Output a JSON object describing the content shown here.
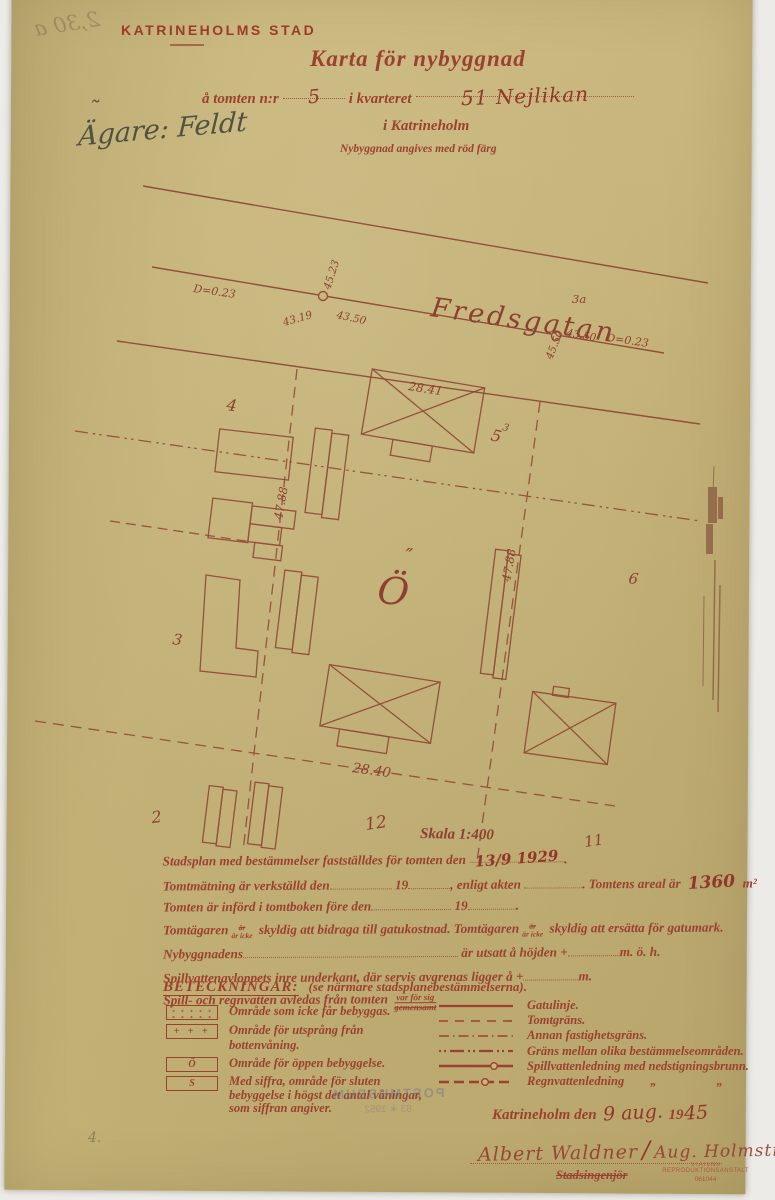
{
  "header": {
    "agency": "KATRINEHOLMS STAD",
    "title": "Karta för nybyggnad",
    "line_pre": "å tomten n:r",
    "plot_no": "5",
    "line_mid": "i kvarteret",
    "block_entry": "51 Nejlikan",
    "city_line": "i Katrineholm",
    "note": "Nybyggnad angives med röd färg",
    "owner_label_and_name": "Ägare: Feldt",
    "owner_tilde": "˜"
  },
  "map": {
    "street_name": "Fredsgatan",
    "d_left": "D=0.23",
    "d_right": "D=0.23",
    "manhole1_left": "43.19",
    "manhole1_up": "45.23",
    "manhole1_right": "43.50",
    "manhole2_label": "3a",
    "manhole2_right": "43.50",
    "manhole2_up": "45.50",
    "frontage_left": "47.88",
    "frontage_right": "47.88",
    "building_top_len": "28.41",
    "building_mid_len": "28.40",
    "plot2": "2",
    "plot3": "3",
    "plot4": "4",
    "plot5": "5",
    "plot5_sup": "3",
    "plot6": "6",
    "plot11": "11",
    "plot12": "12",
    "scale_label": "Skala 1:400",
    "open_symbol": "Ö",
    "open_symbol_marks": "″"
  },
  "form": {
    "l1a": "Stadsplan med bestämmelser fastställdes för tomten den",
    "l1_hand": "13/9 1929",
    "l1_end": ".",
    "l2a": "Tomtmätning är verkställd den",
    "l2b": "19",
    "l2c": ", enligt akten",
    "l2d": ". Tomtens areal är",
    "l2_hand": "1360",
    "l2e": "m²",
    "l3a": "Tomten är införd i tomtboken före den",
    "l3b": "19",
    "l3c": ".",
    "l4a": "Tomtägaren",
    "frac_top": "är",
    "frac_bot": "är icke",
    "l4b": "skyldig att bidraga till gatukostnad. Tomtägaren",
    "l4c": "skyldig att ersätta för gatumark.",
    "l5a": "Nybyggnadens",
    "l5b": "är utsatt å höjden +",
    "l5c": "m. ö. h.",
    "l6a": "Spillvattenavloppets inre underkant, där servis avgrenas ligger å +",
    "l6b": "m.",
    "l7a": "Spill- och regnvatten avledas från tomten",
    "l7_top": "var för sig",
    "l7_bot": "gemensamt"
  },
  "legend": {
    "title": "BETECKNINGAR:",
    "subtitle": "(se närmare stadsplanebestämmelserna).",
    "left": {
      "items": [
        {
          "icon": "dotted-area",
          "symbol": "",
          "text": "Område som icke får bebyggas."
        },
        {
          "icon": "plus-area",
          "symbol": "+ + +",
          "text": "Område för utsprång från bottenvåning."
        },
        {
          "icon": "open-area",
          "symbol": "Ö",
          "text": "Område för öppen bebyggelse."
        },
        {
          "icon": "closed-area",
          "symbol": "S",
          "text": "Med siffra, område för sluten bebyggelse i högst det antal våningar, som siffran angiver."
        }
      ]
    },
    "right": {
      "items": [
        {
          "icon": "solid-line",
          "text": "Gatulinje."
        },
        {
          "icon": "dashed-line",
          "text": "Tomtgräns."
        },
        {
          "icon": "dash-dot-line",
          "text": "Annan fastighetsgräns."
        },
        {
          "icon": "dot-dot-dash-line",
          "text": "Gräns mellan olika bestämmelseområden."
        },
        {
          "icon": "solid-line-manhole",
          "text": "Spillvattenledning med nedstigningsbrunn."
        },
        {
          "icon": "dashed-line-manhole",
          "text": "Regnvattenledning",
          "ditto1": "„",
          "ditto2": "„"
        }
      ]
    }
  },
  "footer": {
    "place": "Katrineholm den",
    "date_hand": "9 aug.",
    "year_printed": "19",
    "year_hand": "45",
    "signature": "Albert Waldner",
    "divider": "∕",
    "cosign": "Aug. Holmström",
    "role": "Stadsingenjör",
    "stamp1": "STATENS REPRODUKTIONSANSTALT",
    "stamp2": "061044"
  },
  "artifacts": {
    "bleed_top": "2,30 a",
    "museum": "POSTMUSEUM",
    "museum2": "83 ∗ 1952",
    "pencil_bottom": "4."
  },
  "colors": {
    "paper": "#c8b67c",
    "ink_red": "#9c4130",
    "map_line": "#8d4030",
    "pencil": "#474a3d"
  }
}
